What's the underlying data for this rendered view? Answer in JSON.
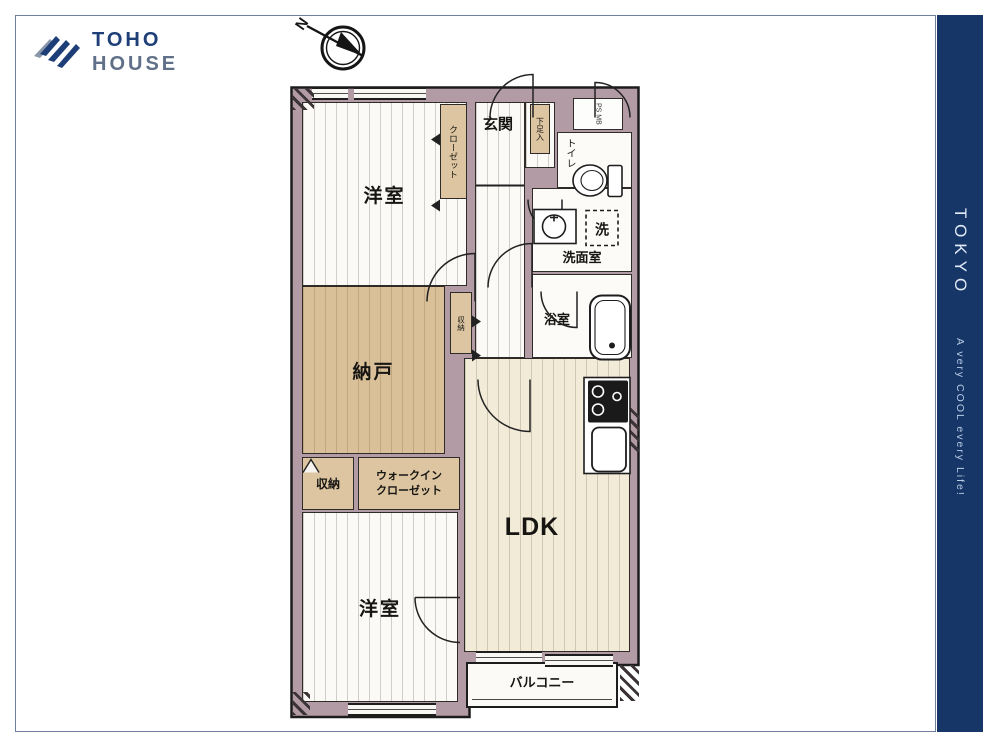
{
  "brand": {
    "line1": "TOHO",
    "line2": "HOUSE"
  },
  "compass": {
    "label": "N"
  },
  "sidebar": {
    "title": "TOKYO",
    "tagline": "A very COOL every Life!",
    "bg_color": "#163667"
  },
  "plan": {
    "colors": {
      "wall": "#b39ba5",
      "tan": "#d9c099",
      "cream": "#f1ebd7"
    },
    "rooms": {
      "bedroom_top": {
        "label": "洋室"
      },
      "closet_top": {
        "label": "クローゼット"
      },
      "genkan": {
        "label": "玄関"
      },
      "shoe": {
        "label": "下足入"
      },
      "psmb": {
        "label": "PS MB"
      },
      "toilet": {
        "label": "トイレ"
      },
      "washer": {
        "label": "洗"
      },
      "washroom": {
        "label": "洗面室"
      },
      "bathroom": {
        "label": "浴室"
      },
      "nando": {
        "label": "納戸"
      },
      "hall_closet": {
        "label": "収納"
      },
      "shuno": {
        "label": "収納"
      },
      "wic": {
        "label_line1": "ウォークイン",
        "label_line2": "クローゼット"
      },
      "ldk": {
        "label": "LDK"
      },
      "bedroom_bottom": {
        "label": "洋室"
      },
      "balcony": {
        "label": "バルコニー"
      }
    }
  }
}
